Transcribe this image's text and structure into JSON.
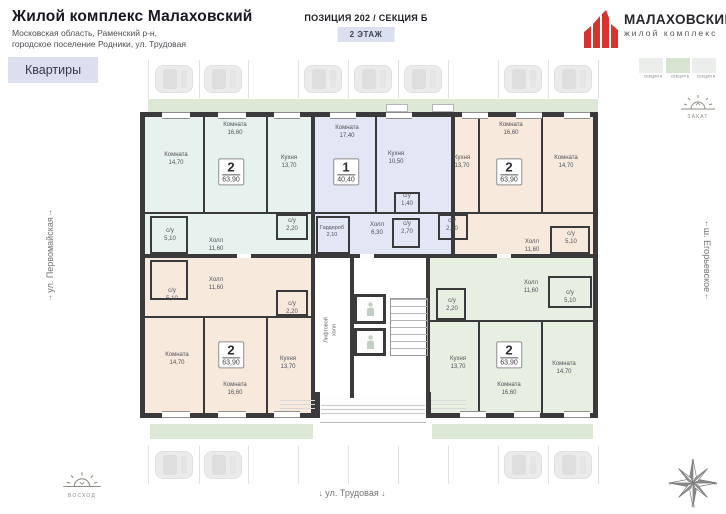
{
  "header": {
    "title": "Жилой комплекс Малаховский",
    "address_line1": "Московская область, Раменский р-н,",
    "address_line2": "городское поселение Родники, ул. Трудовая",
    "tab_label": "Квартиры",
    "position_label": "ПОЗИЦИЯ 202 / СЕКЦИЯ Б",
    "floor_label": "2 ЭТАЖ"
  },
  "logo": {
    "name": "МАЛАХОВСКИЙ",
    "tagline": "жилой комплекс",
    "accent_color": "#d8342e"
  },
  "legend": {
    "sections": [
      {
        "label": "СЕКЦИЯ А"
      },
      {
        "label": "СЕКЦИЯ Б"
      },
      {
        "label": "СЕКЦИЯ В"
      }
    ],
    "active_index": 1,
    "active_color": "#d6e4d0",
    "inactive_color": "#eceeec"
  },
  "orientation": {
    "sunset_label": "ЗАКАТ",
    "sunrise_label": "ВОСХОД",
    "street_left": "ул. Первомайская",
    "street_right": "ш. Егорьевское",
    "street_bottom": "ул. Трудовая",
    "arrow_up": "↑",
    "arrow_down": "↓",
    "compass": {
      "n": "С",
      "e": "В",
      "s": "Ю",
      "w": "З"
    }
  },
  "floor_plan": {
    "core": {
      "elevator_hall_label_line1": "Лифтовой",
      "elevator_hall_label_line2": "холл"
    },
    "apartments": [
      {
        "id": "apt-2k-top-left",
        "type": "2",
        "total_area": "63,90",
        "fill": "#e7f1ee",
        "rooms": [
          {
            "name": "Комната",
            "area": "14,70"
          },
          {
            "name": "Комната",
            "area": "16,60"
          },
          {
            "name": "Кухня",
            "area": "13,70"
          },
          {
            "name": "с/у",
            "area": "5,10"
          },
          {
            "name": "Холл",
            "area": "11,60"
          },
          {
            "name": "с/у",
            "area": "2,20"
          }
        ]
      },
      {
        "id": "apt-1k-top-center",
        "type": "1",
        "total_area": "40,40",
        "fill": "#e3e6f4",
        "rooms": [
          {
            "name": "Комната",
            "area": "17,40"
          },
          {
            "name": "Кухня",
            "area": "10,50"
          },
          {
            "name": "с/у",
            "area": "1,40"
          },
          {
            "name": "с/у",
            "area": "2,70"
          },
          {
            "name": "Гардероб",
            "area": "2,10"
          },
          {
            "name": "Холл",
            "area": "6,30"
          }
        ]
      },
      {
        "id": "apt-2k-top-right",
        "type": "2",
        "total_area": "63,90",
        "fill": "#f7e9dc",
        "rooms": [
          {
            "name": "Кухня",
            "area": "13,70"
          },
          {
            "name": "Комната",
            "area": "16,60"
          },
          {
            "name": "Комната",
            "area": "14,70"
          },
          {
            "name": "с/у",
            "area": "2,20"
          },
          {
            "name": "Холл",
            "area": "11,60"
          },
          {
            "name": "с/у",
            "area": "5,10"
          }
        ]
      },
      {
        "id": "apt-2k-bottom-left",
        "type": "2",
        "total_area": "63,90",
        "fill": "#f7e9dc",
        "rooms": [
          {
            "name": "с/у",
            "area": "5,10"
          },
          {
            "name": "Холл",
            "area": "11,60"
          },
          {
            "name": "с/у",
            "area": "2,20"
          },
          {
            "name": "Комната",
            "area": "14,70"
          },
          {
            "name": "Комната",
            "area": "16,60"
          },
          {
            "name": "Кухня",
            "area": "13,70"
          }
        ]
      },
      {
        "id": "apt-2k-bottom-right",
        "type": "2",
        "total_area": "63,90",
        "fill": "#e7efe2",
        "rooms": [
          {
            "name": "Холл",
            "area": "11,60"
          },
          {
            "name": "с/у",
            "area": "5,10"
          },
          {
            "name": "с/у",
            "area": "2,20"
          },
          {
            "name": "Кухня",
            "area": "13,70"
          },
          {
            "name": "Комната",
            "area": "16,60"
          },
          {
            "name": "Комната",
            "area": "14,70"
          }
        ]
      }
    ]
  },
  "parking": {
    "top_occupancy": [
      true,
      true,
      false,
      true,
      true,
      true,
      false,
      true,
      true
    ],
    "bottom_occupancy": [
      true,
      true,
      false,
      false,
      false,
      false,
      false,
      true,
      true
    ]
  }
}
